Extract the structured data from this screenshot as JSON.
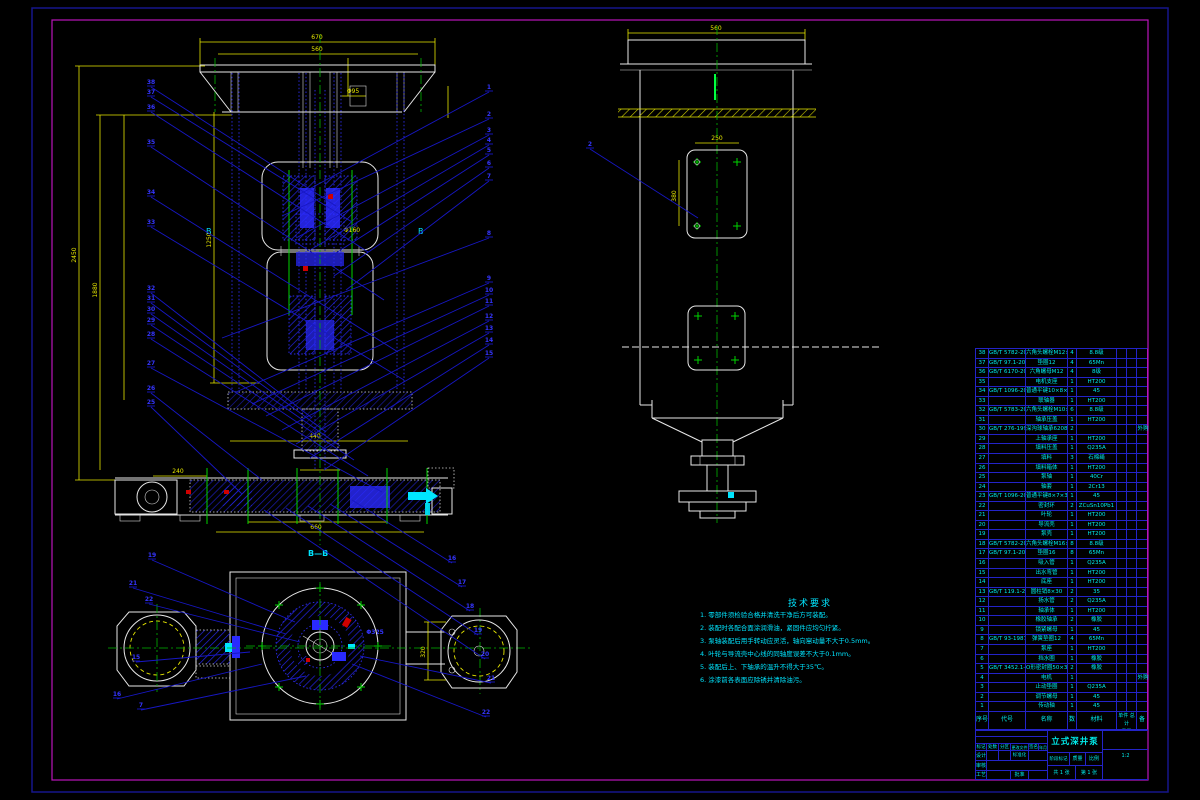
{
  "drawing": {
    "section_label": "B—B",
    "section_marker": "B"
  },
  "dims": {
    "top1": "670",
    "top2": "560",
    "left1": "2450",
    "left2": "1880",
    "left3": "1250",
    "mid1": "Φ160",
    "neck": "Φ95",
    "bottom_a": "440",
    "bottom_b": "660",
    "bottom_c": "240",
    "side_top": "560",
    "panel_w": "250",
    "panel_h": "380",
    "sect_h": "320",
    "sect_note": "Φ325"
  },
  "balloons": {
    "left": [
      "38",
      "37",
      "36",
      "35",
      "34",
      "33",
      "32",
      "31",
      "30",
      "29",
      "28",
      "27",
      "26",
      "25"
    ],
    "right": [
      "1",
      "2",
      "3",
      "4",
      "5",
      "6",
      "7",
      "8",
      "9",
      "10",
      "11",
      "12",
      "13",
      "14",
      "15"
    ],
    "bottom": [
      "16",
      "17",
      "18",
      "19",
      "20",
      "21",
      "22"
    ],
    "section": [
      "19",
      "21",
      "22",
      "15",
      "16",
      "7"
    ],
    "side": [
      "2"
    ]
  },
  "tech_req": {
    "title": "技术要求",
    "lines": [
      "1. 零部件须检验合格并清洗干净后方可装配。",
      "2. 装配时各配合面涂润滑油，紧固件应均匀拧紧。",
      "3. 泵轴装配后用手转动应灵活，轴向窜动量不大于0.5mm。",
      "4. 叶轮与导流壳中心线的同轴度误差不大于0.1mm。",
      "5. 装配后上、下轴承的温升不得大于35℃。",
      "6. 涂漆前各表面应除锈并清除油污。"
    ]
  },
  "bom": {
    "headers": {
      "no": "序号",
      "code": "代号",
      "name": "名称",
      "qty": "数量",
      "mat": "材料",
      "unit": "单件",
      "total": "总计",
      "weight": "重量",
      "note": "备注"
    },
    "rows": [
      [
        "38",
        "GB/T 5782-2000",
        "六角头螺栓M12×45",
        "4",
        "8.8级",
        "",
        "",
        ""
      ],
      [
        "37",
        "GB/T 97.1-2002",
        "垫圈12",
        "4",
        "65Mn",
        "",
        "",
        ""
      ],
      [
        "36",
        "GB/T 6170-2000",
        "六角螺母M12",
        "4",
        "8级",
        "",
        "",
        ""
      ],
      [
        "35",
        "",
        "电机支座",
        "1",
        "HT200",
        "",
        "",
        ""
      ],
      [
        "34",
        "GB/T 1096-2003",
        "普通平键10×8×50",
        "1",
        "45",
        "",
        "",
        ""
      ],
      [
        "33",
        "",
        "联轴器",
        "1",
        "HT200",
        "",
        "",
        ""
      ],
      [
        "32",
        "GB/T 5783-2000",
        "六角头螺栓M10×35",
        "6",
        "8.8级",
        "",
        "",
        ""
      ],
      [
        "31",
        "",
        "轴承压盖",
        "1",
        "HT200",
        "",
        "",
        ""
      ],
      [
        "30",
        "GB/T 276-1994",
        "深沟球轴承6208",
        "2",
        "",
        "",
        "",
        "外购"
      ],
      [
        "29",
        "",
        "上轴承座",
        "1",
        "HT200",
        "",
        "",
        ""
      ],
      [
        "28",
        "",
        "填料压盖",
        "1",
        "Q235A",
        "",
        "",
        ""
      ],
      [
        "27",
        "",
        "填料",
        "3",
        "石棉绳",
        "",
        "",
        ""
      ],
      [
        "26",
        "",
        "填料箱体",
        "1",
        "HT200",
        "",
        "",
        ""
      ],
      [
        "25",
        "",
        "泵轴",
        "1",
        "40Cr",
        "",
        "",
        ""
      ],
      [
        "24",
        "",
        "轴套",
        "1",
        "2Cr13",
        "",
        "",
        ""
      ],
      [
        "23",
        "GB/T 1096-2003",
        "普通平键8×7×36",
        "1",
        "45",
        "",
        "",
        ""
      ],
      [
        "22",
        "",
        "密封环",
        "2",
        "ZCuSn10Pb1",
        "",
        "",
        ""
      ],
      [
        "21",
        "",
        "叶轮",
        "1",
        "HT200",
        "",
        "",
        ""
      ],
      [
        "20",
        "",
        "导流壳",
        "1",
        "HT200",
        "",
        "",
        ""
      ],
      [
        "19",
        "",
        "泵壳",
        "1",
        "HT200",
        "",
        "",
        ""
      ],
      [
        "18",
        "GB/T 5782-2000",
        "六角头螺栓M16×60",
        "8",
        "8.8级",
        "",
        "",
        ""
      ],
      [
        "17",
        "GB/T 97.1-2002",
        "垫圈16",
        "8",
        "65Mn",
        "",
        "",
        ""
      ],
      [
        "16",
        "",
        "吸入管",
        "1",
        "Q235A",
        "",
        "",
        ""
      ],
      [
        "15",
        "",
        "出水弯管",
        "1",
        "HT200",
        "",
        "",
        ""
      ],
      [
        "14",
        "",
        "底座",
        "1",
        "HT200",
        "",
        "",
        ""
      ],
      [
        "13",
        "GB/T 119.1-2000",
        "圆柱销8×30",
        "2",
        "35",
        "",
        "",
        ""
      ],
      [
        "12",
        "",
        "扬水管",
        "2",
        "Q235A",
        "",
        "",
        ""
      ],
      [
        "11",
        "",
        "轴承体",
        "1",
        "HT200",
        "",
        "",
        ""
      ],
      [
        "10",
        "",
        "橡胶轴承",
        "2",
        "橡胶",
        "",
        "",
        ""
      ],
      [
        "9",
        "",
        "锁紧螺母",
        "1",
        "45",
        "",
        "",
        ""
      ],
      [
        "8",
        "GB/T 93-1987",
        "弹簧垫圈12",
        "4",
        "65Mn",
        "",
        "",
        ""
      ],
      [
        "7",
        "",
        "泵座",
        "1",
        "HT200",
        "",
        "",
        ""
      ],
      [
        "6",
        "",
        "挡水圈",
        "1",
        "橡胶",
        "",
        "",
        ""
      ],
      [
        "5",
        "GB/T 3452.1-2005",
        "O形密封圈50×3.55",
        "2",
        "橡胶",
        "",
        "",
        ""
      ],
      [
        "4",
        "",
        "电机",
        "1",
        "",
        "",
        "",
        "外购"
      ],
      [
        "3",
        "",
        "止动垫圈",
        "1",
        "Q235A",
        "",
        "",
        ""
      ],
      [
        "2",
        "",
        "调节螺母",
        "1",
        "45",
        "",
        "",
        ""
      ],
      [
        "1",
        "",
        "传动轴",
        "1",
        "45",
        "",
        "",
        ""
      ]
    ]
  },
  "title_block": {
    "title": "立式深井泵装配图",
    "mark": "标记",
    "count": "处数",
    "zone": "分区",
    "doc_no": "更改文件号",
    "sign": "签名",
    "date": "年月日",
    "design": "设计",
    "check": "审核",
    "process": "工艺",
    "standard": "标准化",
    "approve": "批准",
    "stage": "阶段标记",
    "mass": "质量",
    "scale": "比例",
    "scale_value": "1:2",
    "sheets": "共 1 张",
    "sheet_no": "第 1 张"
  }
}
